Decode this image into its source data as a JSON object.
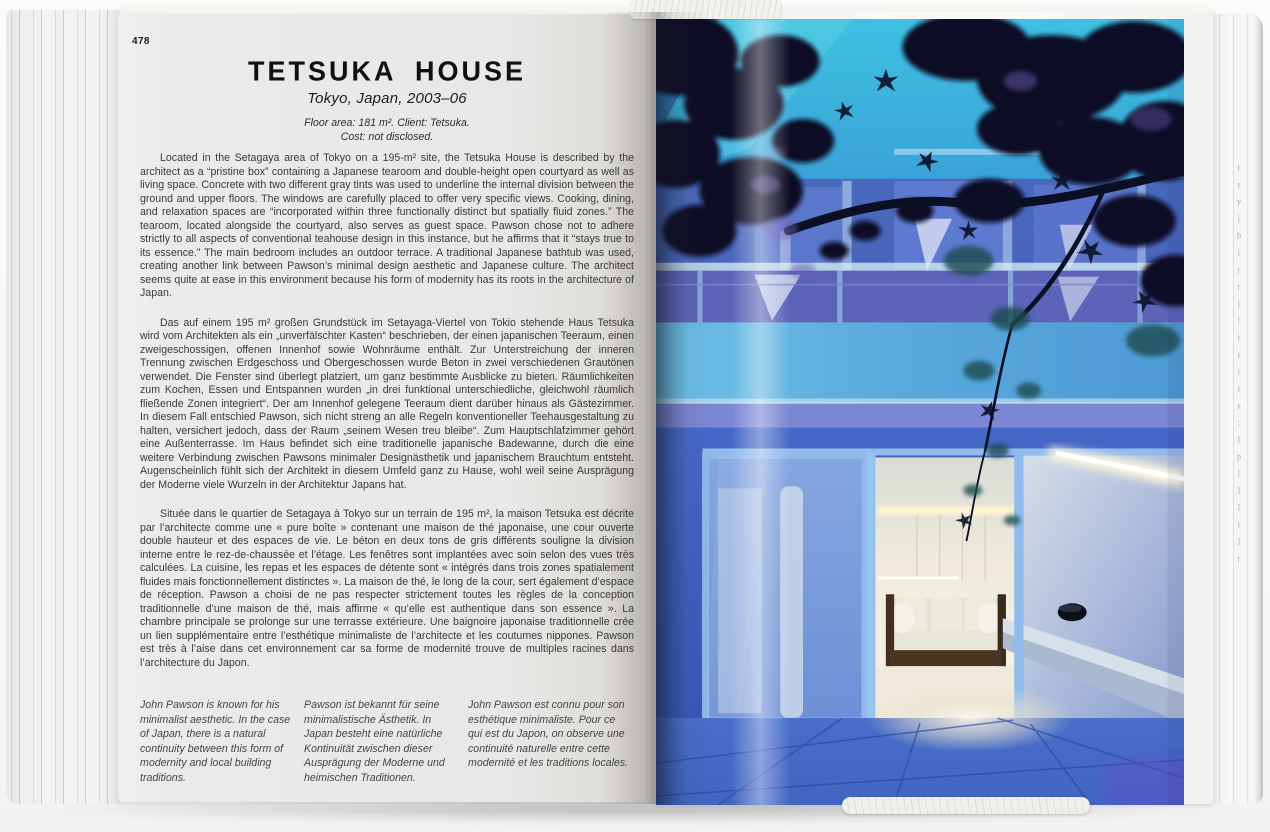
{
  "book": {
    "left_page": {
      "page_number": "478",
      "title": "TETSUKA HOUSE",
      "subtitle": "Tokyo, Japan, 2003–06",
      "meta_line1": "Floor area: 181 m². Client: Tetsuka.",
      "meta_line2": "Cost: not disclosed.",
      "paragraphs": {
        "english": "Located in the Setagaya area of Tokyo on a 195-m² site, the Tetsuka House is described by the architect as a “pristine box” containing a Japanese tearoom and double-height open courtyard as well as living space. Concrete with two different gray tints was used to underline the internal division between the ground and upper floors. The windows are carefully placed to offer very specific views. Cooking, dining, and relaxation spaces are “incorporated within three functionally distinct but spatially fluid zones.” The tearoom, located alongside the courtyard, also serves as guest space. Pawson chose not to adhere strictly to all aspects of conventional teahouse design in this instance, but he affirms that it “stays true to its essence.” The main bedroom includes an outdoor terrace. A traditional Japanese bathtub was used, creating another link between Pawson’s minimal design aesthetic and Japanese culture. The architect seems quite at ease in this environment because his form of modernity has its roots in the architecture of Japan.",
        "german": "Das auf einem 195 m² großen Grundstück im Setayaga-Viertel von Tokio stehende Haus Tetsuka wird vom Architekten als ein „unverfälschter Kasten“ beschrieben, der einen japanischen Teeraum, einen zweigeschossigen, offenen Innenhof sowie Wohnräume enthält. Zur Unterstreichung der inneren Trennung zwischen Erdgeschoss und Obergeschossen wurde Beton in zwei verschiedenen Grautönen verwendet. Die Fenster sind überlegt platziert, um ganz bestimmte Ausblicke zu bieten. Räumlichkeiten zum Kochen, Essen und Entspannen wurden „in drei funktional unterschiedliche, gleichwohl räumlich fließende Zonen integriert“. Der am Innenhof gelegene Teeraum dient darüber hinaus als Gästezimmer. In diesem Fall entschied Pawson, sich nicht streng an alle Regeln konventioneller Teehausgestaltung zu halten, versichert jedoch, dass der Raum „seinem Wesen treu bleibe“. Zum Hauptschlafzimmer gehört eine Außenterrasse. Im Haus befindet sich eine traditionelle japanische Badewanne, durch die eine weitere Verbindung zwischen Pawsons minimaler Designästhetik und japanischem Brauchtum entsteht. Augenscheinlich fühlt sich der Architekt in diesem Umfeld ganz zu Hause, wohl weil seine Ausprägung der Moderne viele Wurzeln in der Architektur Japans hat.",
        "french": "Située dans le quartier de Setagaya à Tokyo sur un terrain de 195 m², la maison Tetsuka est décrite par l’architecte comme une « pure boîte » contenant une maison de thé japonaise, une cour ouverte double hauteur et des espaces de vie. Le béton en deux tons de gris différents souligne la division interne entre le rez-de-chaussée et l’étage. Les fenêtres sont implantées avec soin selon des vues très calculées. La cuisine, les repas et les espaces de détente sont « intégrés dans trois zones spatialement fluides mais fonctionnellement distinctes ». La maison de thé, le long de la cour, sert également d’espace de réception. Pawson a choisi de ne pas respecter strictement toutes les règles de la conception traditionnelle d’une maison de thé, mais affirme « qu’elle est authentique dans son essence ». La chambre principale se prolonge sur une terrasse extérieure. Une baignoire japonaise traditionnelle crée un lien supplémentaire entre l’esthétique minimaliste de l’architecte et les coutumes nippones. Pawson est très à l’aise dans cet environnement car sa forme de modernité trouve de multiples racines dans l’architecture du Japon."
      },
      "captions": {
        "english": "John Pawson is known for his minimalist aesthetic. In the case of Japan, there is a natural continuity between this form of modernity and local building traditions.",
        "german": "Pawson ist bekannt für seine minimalistische Ästhetik. In Japan besteht eine natürliche Kontinuität zwischen dieser Ausprägung der Moderne und heimischen Traditionen.",
        "french": "John Pawson est connu pour son esthétique minimaliste. Pour ce qui est du Japon, on observe une continuité naturelle entre cette modernité et les traditions locales."
      }
    },
    "right_page": {
      "photo_subject": "Twilight view through dark maple branches of the blue-lit Tetsuka House facade; open glass doors reveal a warm white interior with a wood-framed sofa, a long stone bench and a black bowl",
      "palette": {
        "sky_cyan": "#3fb8dc",
        "facade_blue": "#4a5fb6",
        "parapet_blue": "#58a8dc",
        "ground_blue": "#3c5cbe",
        "foliage_dark": "#0b1126",
        "foliage_purple": "#6b5cae",
        "interior_warm_white": "#f7f3e6",
        "cove_light": "#fff7dd",
        "floor_blue": "#4a74cc"
      }
    },
    "fore_edge": {
      "glyphs": [
        "r",
        "s",
        "y",
        "j",
        "b",
        "i",
        "r",
        "r",
        "j",
        "!",
        "t",
        "s",
        "i",
        "s",
        "s",
        ":",
        "1",
        "p",
        "l",
        "1",
        "1",
        "t",
        "1",
        "r"
      ]
    }
  }
}
